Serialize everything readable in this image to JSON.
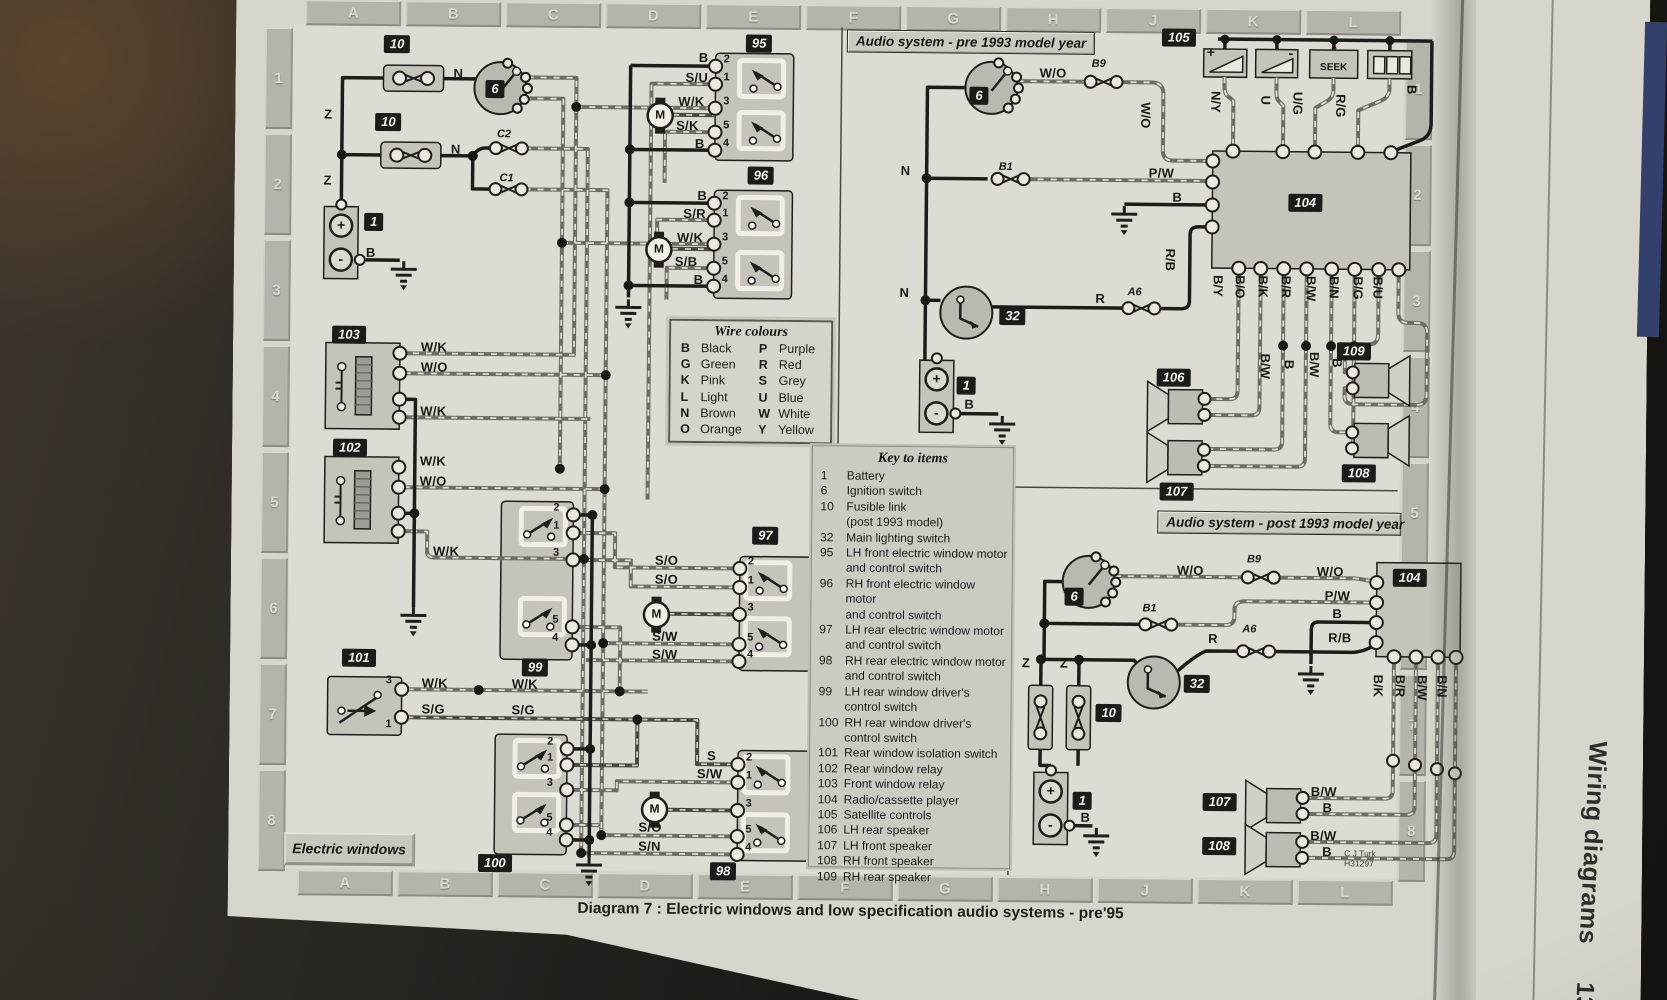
{
  "page": {
    "caption": "Diagram 7 : Electric windows and low specification audio systems - pre'95",
    "margin_title": "Wiring diagrams",
    "margin_page": "13•33",
    "credit_line1": "C J Turk",
    "credit_line2": "H31297"
  },
  "grid": {
    "letters": [
      "A",
      "B",
      "C",
      "D",
      "E",
      "F",
      "G",
      "H",
      "J",
      "K",
      "L"
    ],
    "numbers": [
      "1",
      "2",
      "3",
      "4",
      "5",
      "6",
      "7",
      "8"
    ]
  },
  "section_titles": {
    "audio_pre": "Audio system - pre 1993 model year",
    "audio_post": "Audio system - post 1993 model year",
    "electric_windows": "Electric windows"
  },
  "wire_colours": {
    "title": "Wire colours",
    "entries": [
      {
        "code": "B",
        "name": "Black"
      },
      {
        "code": "P",
        "name": "Purple"
      },
      {
        "code": "G",
        "name": "Green"
      },
      {
        "code": "R",
        "name": "Red"
      },
      {
        "code": "K",
        "name": "Pink"
      },
      {
        "code": "S",
        "name": "Grey"
      },
      {
        "code": "L",
        "name": "Light"
      },
      {
        "code": "U",
        "name": "Blue"
      },
      {
        "code": "N",
        "name": "Brown"
      },
      {
        "code": "W",
        "name": "White"
      },
      {
        "code": "O",
        "name": "Orange"
      },
      {
        "code": "Y",
        "name": "Yellow"
      }
    ]
  },
  "key_to_items": {
    "title": "Key to items",
    "items": [
      {
        "num": "1",
        "text": "Battery"
      },
      {
        "num": "6",
        "text": "Ignition switch"
      },
      {
        "num": "10",
        "text": "Fusible link\n(post 1993 model)"
      },
      {
        "num": "32",
        "text": "Main lighting switch"
      },
      {
        "num": "95",
        "text": "LH front electric window motor\nand control switch"
      },
      {
        "num": "96",
        "text": "RH front electric window motor\nand control switch"
      },
      {
        "num": "97",
        "text": "LH rear electric window motor\nand control switch"
      },
      {
        "num": "98",
        "text": "RH rear electric window motor\nand control switch"
      },
      {
        "num": "99",
        "text": "LH rear window driver's\ncontrol switch"
      },
      {
        "num": "100",
        "text": "RH rear window driver's\ncontrol switch"
      },
      {
        "num": "101",
        "text": "Rear window isolation switch"
      },
      {
        "num": "102",
        "text": "Rear window relay"
      },
      {
        "num": "103",
        "text": "Front window relay"
      },
      {
        "num": "104",
        "text": "Radio/cassette player"
      },
      {
        "num": "105",
        "text": "Satellite controls"
      },
      {
        "num": "106",
        "text": "LH rear speaker"
      },
      {
        "num": "107",
        "text": "LH front speaker"
      },
      {
        "num": "108",
        "text": "RH front speaker"
      },
      {
        "num": "109",
        "text": "RH rear speaker"
      }
    ]
  },
  "badges": [
    "10",
    "6",
    "10",
    "1",
    "95",
    "96",
    "103",
    "102",
    "101",
    "99",
    "100",
    "97",
    "98",
    "105",
    "6",
    "32",
    "1",
    "104",
    "106",
    "107",
    "109",
    "108",
    "6",
    "32",
    "10",
    "1",
    "104",
    "107",
    "108"
  ],
  "wire_labels": [
    "N",
    "Z",
    "N",
    "C2",
    "C1",
    "Z",
    "B",
    "B",
    "S/U",
    "W/K",
    "S/K",
    "B",
    "B",
    "S/R",
    "W/K",
    "S/B",
    "B",
    "W/K",
    "W/O",
    "W/K",
    "W/K",
    "W/O",
    "W/K",
    "W/K",
    "S/G",
    "W/K",
    "S/G",
    "S/O",
    "S/O",
    "S/W",
    "S/W",
    "S",
    "S/W",
    "S/O",
    "S/N",
    "W/O",
    "B9",
    "W/O",
    "N",
    "B1",
    "P/W",
    "B",
    "N",
    "R",
    "A6",
    "R/B",
    "B",
    "N/Y",
    "U",
    "U/G",
    "R/G",
    "B",
    "B/Y",
    "B/O",
    "B/K",
    "B/R",
    "B/W",
    "B/N",
    "B/G",
    "B/U",
    "B/W",
    "B",
    "B/W",
    "B",
    "W/O",
    "B9",
    "W/O",
    "P/W",
    "B",
    "B1",
    "R",
    "A6",
    "R/B",
    "Z",
    "Z",
    "B",
    "B/K",
    "B/R",
    "B/W",
    "B/N",
    "B/W",
    "B",
    "B/W",
    "B"
  ],
  "terminal_sequences": {
    "window": [
      "2",
      "1",
      "3",
      "5",
      "4"
    ],
    "isolation": [
      "3",
      "1"
    ]
  },
  "glyphs": {
    "motor": "M",
    "plus": "+",
    "minus": "-",
    "seek": "SEEK",
    "caret": "ˆ"
  },
  "satellite_icons": [
    "volume-up",
    "volume-down",
    "seek",
    "preset-buttons"
  ]
}
